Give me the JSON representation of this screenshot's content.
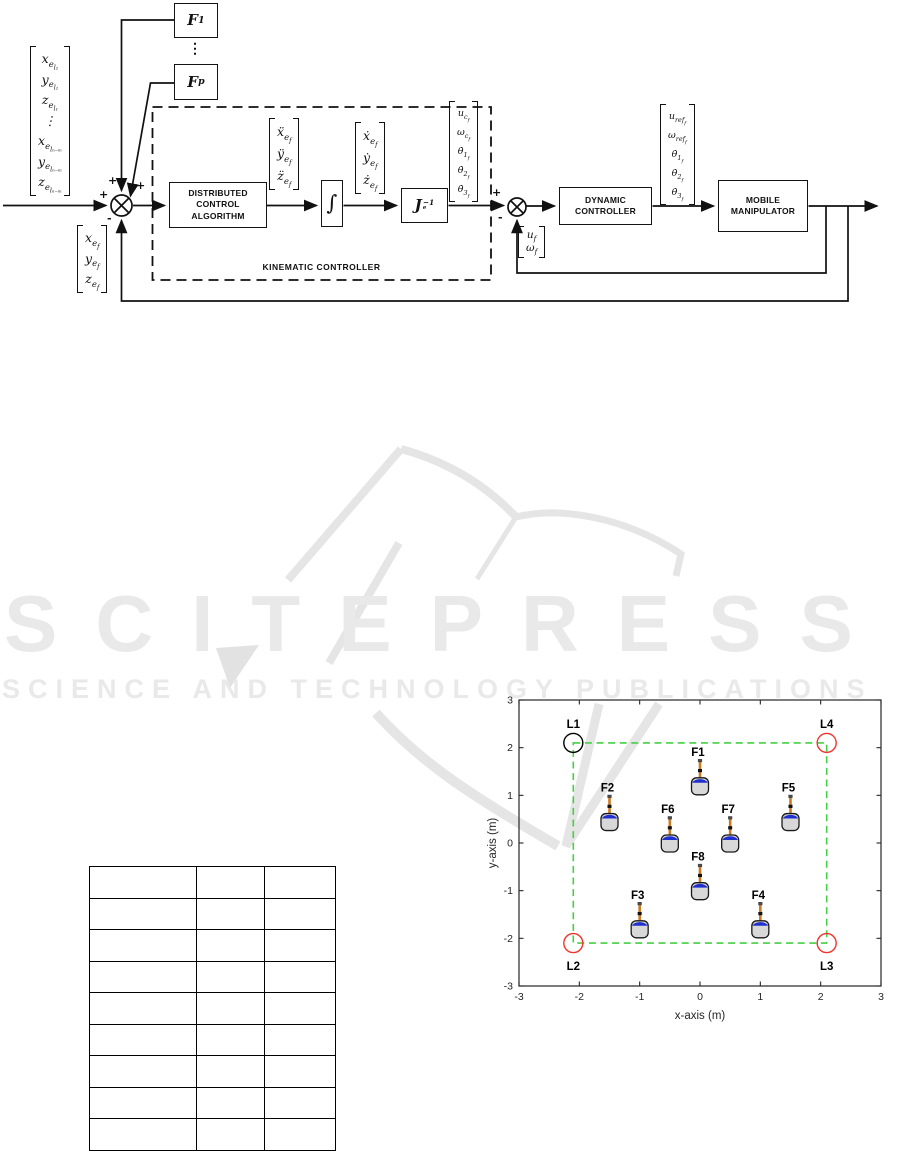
{
  "watermark": {
    "title": "SCITEPRESS",
    "subtitle": "SCIENCE AND TECHNOLOGY PUBLICATIONS",
    "color": "#e9e9e9"
  },
  "diagram": {
    "blocks": {
      "f1_base": "F",
      "f1_sub": "1",
      "fp_base": "F",
      "fp_sub": "p",
      "dots": "⋮",
      "distributed": "DISTRIBUTED\nCONTROL\nALGORITHM",
      "integrator": "∫",
      "jacobian_base": "J",
      "jacobian_sub": "e",
      "jacobian_sup": "−1",
      "kinematic_label": "KINEMATIC CONTROLLER",
      "dynamic": "DYNAMIC\nCONTROLLER",
      "mobile": "MOBILE\nMANIPULATOR"
    },
    "sum1_signs": {
      "left": "+",
      "top": "+",
      "topright": "+",
      "bottom": "-"
    },
    "sum2_signs": {
      "top": "+",
      "bottom": "-"
    },
    "vectors": {
      "input": [
        [
          "x",
          "e",
          "l₁"
        ],
        [
          "y",
          "e",
          "l₁"
        ],
        [
          "z",
          "e",
          "l₁"
        ],
        [
          "⋮",
          "",
          ""
        ],
        [
          "x",
          "e",
          "lₙ₋ₘ"
        ],
        [
          "y",
          "e",
          "lₙ₋ₘ"
        ],
        [
          "z",
          "e",
          "lₙ₋ₘ"
        ]
      ],
      "accel": [
        [
          "ẍ",
          "e",
          "f"
        ],
        [
          "ÿ",
          "e",
          "f"
        ],
        [
          "z̈",
          "e",
          "f"
        ]
      ],
      "vel": [
        [
          "ẋ",
          "e",
          "f"
        ],
        [
          "ẏ",
          "e",
          "f"
        ],
        [
          "ż",
          "e",
          "f"
        ]
      ],
      "kin_out": [
        [
          "u",
          "c",
          "f"
        ],
        [
          "ω",
          "c",
          "f"
        ],
        [
          "θ̇",
          "1",
          "f"
        ],
        [
          "θ̇",
          "2",
          "f"
        ],
        [
          "θ̇",
          "3",
          "f"
        ]
      ],
      "ref": [
        [
          "u",
          "ref",
          "f"
        ],
        [
          "ω",
          "ref",
          "f"
        ],
        [
          "θ̇",
          "1",
          "f"
        ],
        [
          "θ̇",
          "2",
          "f"
        ],
        [
          "θ̇",
          "3",
          "f"
        ]
      ],
      "pos_fb": [
        [
          "x",
          "e",
          "f"
        ],
        [
          "y",
          "e",
          "f"
        ],
        [
          "z",
          "e",
          "f"
        ]
      ],
      "vel_fb": [
        [
          "u",
          "f",
          ""
        ],
        [
          "ω",
          "f",
          ""
        ]
      ]
    }
  },
  "table": {
    "rows": [
      [
        "",
        "",
        ""
      ],
      [
        "",
        "",
        ""
      ],
      [
        "",
        "",
        ""
      ],
      [
        "",
        "",
        ""
      ],
      [
        "",
        "",
        ""
      ],
      [
        "",
        "",
        ""
      ],
      [
        "",
        "",
        ""
      ],
      [
        "",
        "",
        ""
      ],
      [
        "",
        "",
        ""
      ]
    ]
  },
  "chart_data": {
    "type": "scatter",
    "title": "",
    "xlabel": "x-axis (m)",
    "ylabel": "y-axis (m)",
    "xlim": [
      -3,
      3
    ],
    "ylim": [
      -3,
      3
    ],
    "xticks": [
      -3,
      -2,
      -1,
      0,
      1,
      2,
      3
    ],
    "yticks": [
      -3,
      -2,
      -1,
      0,
      1,
      2,
      3
    ],
    "grid": false,
    "legend": null,
    "leaders": [
      {
        "label": "L1",
        "x": -2.1,
        "y": 2.1,
        "color": "#000000"
      },
      {
        "label": "L2",
        "x": -2.1,
        "y": -2.1,
        "color": "#f0342b"
      },
      {
        "label": "L3",
        "x": 2.1,
        "y": -2.1,
        "color": "#f0342b"
      },
      {
        "label": "L4",
        "x": 2.1,
        "y": 2.1,
        "color": "#f0342b"
      }
    ],
    "followers": [
      {
        "label": "F1",
        "x": 0.0,
        "y": 1.2
      },
      {
        "label": "F2",
        "x": -1.5,
        "y": 0.45
      },
      {
        "label": "F3",
        "x": -1.0,
        "y": -1.8
      },
      {
        "label": "F4",
        "x": 1.0,
        "y": -1.8
      },
      {
        "label": "F5",
        "x": 1.5,
        "y": 0.45
      },
      {
        "label": "F6",
        "x": -0.5,
        "y": 0.0
      },
      {
        "label": "F7",
        "x": 0.5,
        "y": 0.0
      },
      {
        "label": "F8",
        "x": 0.0,
        "y": -1.0
      }
    ],
    "formation_square": {
      "x1": -2.1,
      "y1": -2.1,
      "x2": 2.1,
      "y2": 2.1,
      "color": "#44d144",
      "style": "dashed"
    },
    "marker_colors": {
      "robot_body": "#d8d8d8",
      "robot_outline": "#1a1a1a",
      "robot_cap": "#1f2fd0",
      "robot_arm": "#c97a22",
      "axis": "#262626"
    }
  }
}
